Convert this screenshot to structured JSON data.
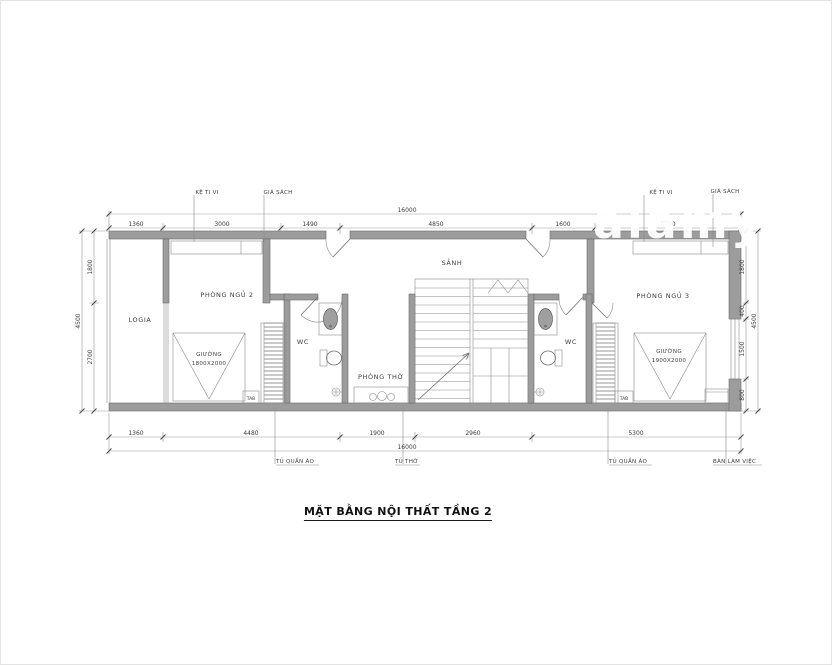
{
  "watermark": "alamy",
  "title": "MẶT BẰNG NỘI THẤT TẦNG 2",
  "rooms": {
    "logia": "LOGIA",
    "bedroom2": "PHÒNG NGỦ 2",
    "hall": "SẢNH",
    "worship": "PHÒNG THỜ",
    "wc_left": "WC",
    "wc_right": "WC",
    "bedroom3": "PHÒNG NGỦ 3"
  },
  "furniture": {
    "tv_shelf_left": "KỆ TI VI",
    "bookshelf_left": "GIÁ SÁCH",
    "tv_shelf_right": "KỆ TI VI",
    "bookshelf_right": "GIÁ SÁCH",
    "bed_left_line1": "GIƯỜNG",
    "bed_left_line2": "1800X2000",
    "bed_right_line1": "GIƯỜNG",
    "bed_right_line2": "1900X2000",
    "tab_left": "TAB",
    "tab_right": "TAB",
    "wardrobe_left": "TỦ QUẦN ÁO",
    "altar_cabinet": "TỦ THỜ",
    "wardrobe_right": "TỦ QUẦN ÁO",
    "desk": "BÀN LÀM VIỆC"
  },
  "dimensions": {
    "top_total": "16000",
    "top_segments": [
      "1360",
      "3000",
      "1490",
      "4850",
      "1600",
      "3700"
    ],
    "bottom_segments": [
      "1360",
      "4480",
      "1900",
      "2960",
      "5300"
    ],
    "bottom_total": "16000",
    "left_segments": [
      "1800",
      "2700"
    ],
    "left_total": "4500",
    "right_segments": [
      "1800",
      "400",
      "1500",
      "800"
    ],
    "right_total": "4500"
  }
}
